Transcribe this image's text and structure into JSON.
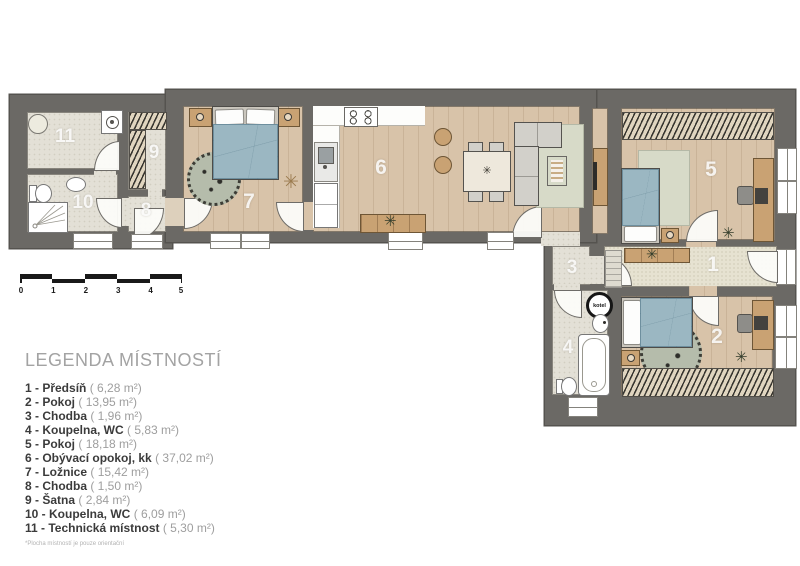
{
  "legend": {
    "title": "LEGENDA MÍSTNOSTÍ",
    "items": [
      {
        "name": "1 - Předsíň",
        "area": "( 6,28 m²)"
      },
      {
        "name": "2 - Pokoj",
        "area": "( 13,95 m²)"
      },
      {
        "name": "3 - Chodba",
        "area": "( 1,96 m²)"
      },
      {
        "name": "4 - Koupelna, WC",
        "area": "( 5,83 m²)"
      },
      {
        "name": "5 - Pokoj",
        "area": "( 18,18 m²)"
      },
      {
        "name": "6 - Obývací opokoj, kk",
        "area": "( 37,02 m²)"
      },
      {
        "name": "7 - Ložnice",
        "area": "( 15,42 m²)"
      },
      {
        "name": "8 - Chodba",
        "area": "( 1,50 m²)"
      },
      {
        "name": "9 - Šatna",
        "area": "( 2,84 m²)"
      },
      {
        "name": "10 - Koupelna, WC",
        "area": "( 6,09 m²)"
      },
      {
        "name": "11 - Technická místnost",
        "area": "( 5,30 m²)"
      }
    ],
    "footnote": "*Plocha místností je pouze orientační"
  },
  "scale_bar": {
    "labels": [
      "0",
      "1",
      "2",
      "3",
      "4",
      "5"
    ]
  },
  "plan": {
    "rooms": {
      "n1": "1",
      "n2": "2",
      "n3": "3",
      "n4": "4",
      "n5": "5",
      "n6": "6",
      "n7": "7",
      "n8": "8",
      "n9": "9",
      "n10": "10",
      "n11": "11"
    },
    "boiler_label": "kotel"
  },
  "icons": {
    "plant": "✳"
  },
  "colors": {
    "wall": "#6b6965",
    "wood_floor": "#d8c3a9",
    "tile_floor": "#e3e0d6",
    "bed_blue": "#9bb7c2"
  }
}
